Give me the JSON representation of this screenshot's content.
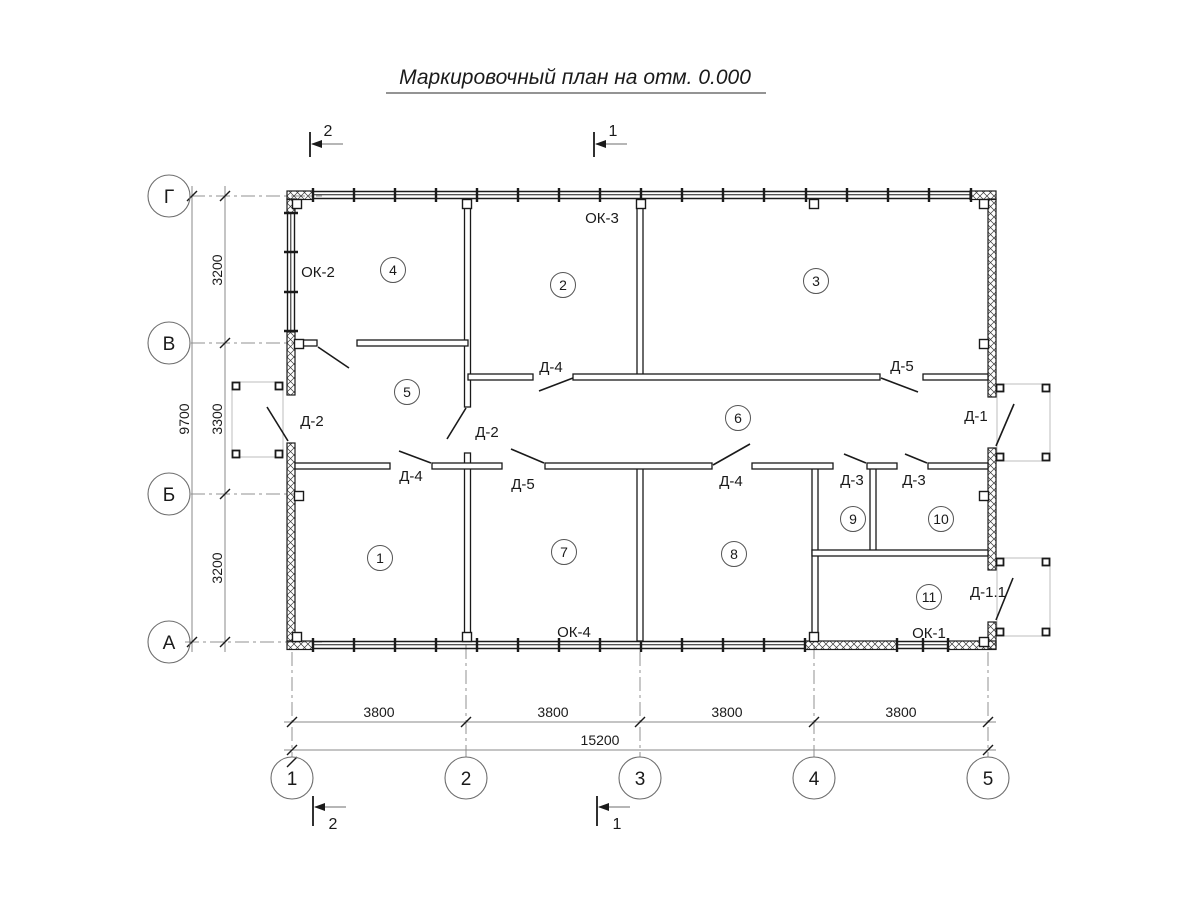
{
  "title": "Маркировочный план на отм. 0.000",
  "axes": {
    "vertical": [
      "Г",
      "В",
      "Б",
      "А"
    ],
    "horizontal": [
      "1",
      "2",
      "3",
      "4",
      "5"
    ]
  },
  "dimensions": {
    "left_segments": [
      "3200",
      "3300",
      "3200"
    ],
    "left_total": "9700",
    "bottom_segments": [
      "3800",
      "3800",
      "3800",
      "3800"
    ],
    "bottom_total": "15200"
  },
  "rooms": [
    "1",
    "2",
    "3",
    "4",
    "5",
    "6",
    "7",
    "8",
    "9",
    "10",
    "11"
  ],
  "door_labels": {
    "d2_ext": "Д-2",
    "d2_int": "Д-2",
    "d4_room2": "Д-4",
    "d5_room3": "Д-5",
    "d4_room1": "Д-4",
    "d5_room7": "Д-5",
    "d4_room8": "Д-4",
    "d3_room9": "Д-3",
    "d3_room10": "Д-3",
    "d1": "Д-1",
    "d1_1": "Д-1.1"
  },
  "window_labels": {
    "ok1": "ОК-1",
    "ok2": "ОК-2",
    "ok3": "ОК-3",
    "ok4": "ОК-4"
  },
  "section_marks": {
    "one": "1",
    "two": "2"
  },
  "colors": {
    "line": "#1a1a1a",
    "secondary": "#8a8a8a",
    "porch_outline": "#bdbdbd",
    "background": "#ffffff"
  }
}
